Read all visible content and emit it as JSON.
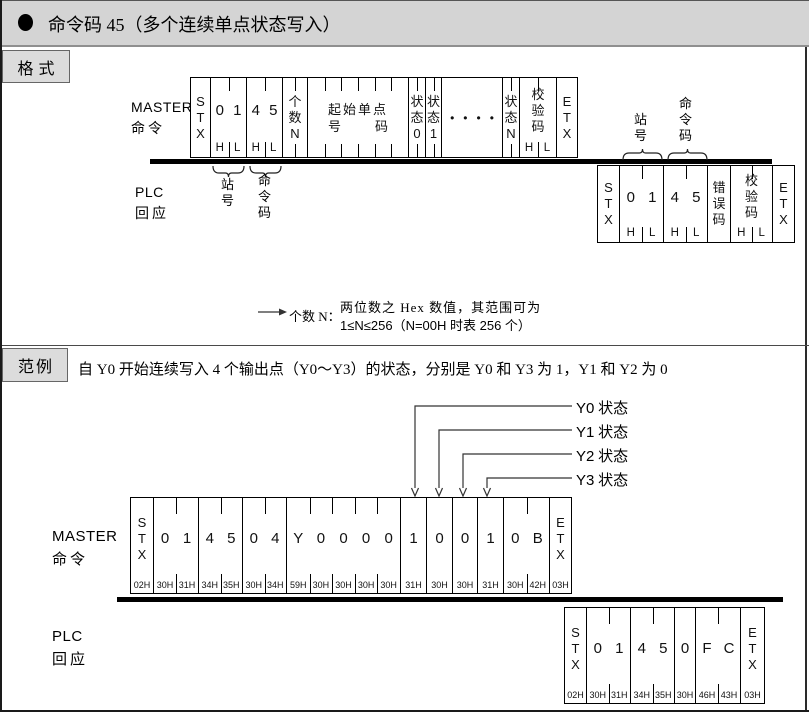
{
  "header": {
    "bullet": "●",
    "title": "命令码 45（多个连续单点状态写入）"
  },
  "format_section": {
    "tab_label": "格式",
    "master_label": {
      "line1": "MASTER",
      "line2": "命令"
    },
    "plc_label": {
      "line1": "PLC",
      "line2": "回应"
    },
    "master_frame": {
      "cells": [
        {
          "w": 21,
          "type": "v",
          "chars": "STX"
        },
        {
          "w": 37,
          "type": "h",
          "chars": [
            "0",
            "1"
          ],
          "sub": [
            "H",
            "L"
          ],
          "topTicks": [
            0.5
          ]
        },
        {
          "w": 37,
          "type": "h",
          "chars": [
            "4",
            "5"
          ],
          "sub": [
            "H",
            "L"
          ],
          "topTicks": [
            0.5
          ]
        },
        {
          "w": 26,
          "type": "v",
          "chars": "个数N",
          "topTicks": [
            0.5
          ],
          "botTicks": [
            0.5
          ]
        },
        {
          "w": 102,
          "type": "wide",
          "line1": "起始单点",
          "line2chars": [
            "号",
            "码"
          ],
          "topTicks": [
            0.167,
            0.333,
            0.5,
            0.667,
            0.833
          ],
          "botTicks": [
            0.167,
            0.333,
            0.5,
            0.667,
            0.833
          ]
        },
        {
          "w": 18,
          "type": "v",
          "chars": "状态0",
          "topTicks": [
            0.5
          ],
          "botTicks": [
            0.5
          ]
        },
        {
          "w": 17,
          "type": "v",
          "chars": "状态1",
          "topTicks": [
            0.5
          ],
          "botTicks": [
            0.5
          ]
        },
        {
          "w": 62,
          "type": "dots",
          "chars": "••••"
        },
        {
          "w": 18,
          "type": "v",
          "chars": "状态N",
          "topTicks": [
            0.5
          ],
          "botTicks": [
            0.5
          ]
        },
        {
          "w": 38,
          "type": "v",
          "chars": "校验码",
          "sub": [
            "H",
            "L"
          ],
          "topTicks": [
            0.5
          ]
        },
        {
          "w": 22,
          "type": "v",
          "chars": "ETX"
        }
      ]
    },
    "master_braces": [
      {
        "label": "站号"
      },
      {
        "label": "命令码"
      }
    ],
    "plc_frame": {
      "cells": [
        {
          "w": 23,
          "type": "v",
          "chars": "STX"
        },
        {
          "w": 45,
          "type": "h",
          "chars": [
            "0",
            "1"
          ],
          "sub": [
            "H",
            "L"
          ],
          "topTicks": [
            0.5
          ]
        },
        {
          "w": 45,
          "type": "h",
          "chars": [
            "4",
            "5"
          ],
          "sub": [
            "H",
            "L"
          ],
          "topTicks": [
            0.5
          ]
        },
        {
          "w": 24,
          "type": "v",
          "chars": "错误码"
        },
        {
          "w": 43,
          "type": "v",
          "chars": "校验码",
          "sub": [
            "H",
            "L"
          ],
          "topTicks": [
            0.5
          ]
        },
        {
          "w": 23,
          "type": "v",
          "chars": "ETX"
        }
      ]
    },
    "plc_braces": [
      {
        "label": "站号"
      },
      {
        "label": "命令码"
      }
    ],
    "note": {
      "lead": "个数 N：",
      "line1": "两位数之 Hex 数值，其范围可为",
      "line2": "1≤N≤256（N=00H 时表 256 个）"
    }
  },
  "example_section": {
    "tab_label": "范例",
    "description": "自 Y0 开始连续写入 4 个输出点（Y0～Y3）的状态，分别是 Y0 和 Y3 为 1，Y1 和 Y2 为 0",
    "pointer_labels": [
      {
        "latin": "Y0",
        "cjk": " 状态"
      },
      {
        "latin": "Y1",
        "cjk": " 状态"
      },
      {
        "latin": "Y2",
        "cjk": " 状态"
      },
      {
        "latin": "Y3",
        "cjk": " 状态"
      }
    ],
    "master_label": {
      "line1": "MASTER",
      "line2": "命令"
    },
    "plc_label": {
      "line1": "PLC",
      "line2": "回应"
    },
    "master_frame": {
      "cells": [
        {
          "w": 24,
          "type": "v",
          "chars": "STX",
          "hex": [
            "02H"
          ]
        },
        {
          "w": 46,
          "type": "h",
          "chars": [
            "0",
            "1"
          ],
          "hex": [
            "30H",
            "31H"
          ],
          "topTicks": [
            0.5
          ]
        },
        {
          "w": 45,
          "type": "h",
          "chars": [
            "4",
            "5"
          ],
          "hex": [
            "34H",
            "35H"
          ],
          "topTicks": [
            0.5
          ]
        },
        {
          "w": 45,
          "type": "h",
          "chars": [
            "0",
            "4"
          ],
          "hex": [
            "30H",
            "34H"
          ],
          "topTicks": [
            0.5
          ]
        },
        {
          "w": 115,
          "type": "h",
          "chars": [
            "Y",
            "0",
            "0",
            "0",
            "0"
          ],
          "hex": [
            "59H",
            "30H",
            "30H",
            "30H",
            "30H"
          ],
          "topTicks": [
            0.2,
            0.4,
            0.6,
            0.8
          ]
        },
        {
          "w": 27,
          "type": "h",
          "chars": [
            "1"
          ],
          "hex": [
            "31H"
          ]
        },
        {
          "w": 27,
          "type": "h",
          "chars": [
            "0"
          ],
          "hex": [
            "30H"
          ]
        },
        {
          "w": 26,
          "type": "h",
          "chars": [
            "0"
          ],
          "hex": [
            "30H"
          ]
        },
        {
          "w": 27,
          "type": "h",
          "chars": [
            "1"
          ],
          "hex": [
            "31H"
          ]
        },
        {
          "w": 47,
          "type": "h",
          "chars": [
            "0",
            "B"
          ],
          "hex": [
            "30H",
            "42H"
          ],
          "topTicks": [
            0.5
          ]
        },
        {
          "w": 23,
          "type": "v",
          "chars": "ETX",
          "hex": [
            "03H"
          ]
        }
      ]
    },
    "plc_frame": {
      "cells": [
        {
          "w": 23,
          "type": "v",
          "chars": "STX",
          "hex": [
            "02H"
          ]
        },
        {
          "w": 45,
          "type": "h",
          "chars": [
            "0",
            "1"
          ],
          "hex": [
            "30H",
            "31H"
          ],
          "topTicks": [
            0.5
          ]
        },
        {
          "w": 45,
          "type": "h",
          "chars": [
            "4",
            "5"
          ],
          "hex": [
            "34H",
            "35H"
          ],
          "topTicks": [
            0.5
          ]
        },
        {
          "w": 22,
          "type": "h",
          "chars": [
            "0"
          ],
          "hex": [
            "30H"
          ]
        },
        {
          "w": 46,
          "type": "h",
          "chars": [
            "F",
            "C"
          ],
          "hex": [
            "46H",
            "43H"
          ],
          "topTicks": [
            0.5
          ]
        },
        {
          "w": 25,
          "type": "v",
          "chars": "ETX",
          "hex": [
            "03H"
          ]
        }
      ]
    }
  }
}
